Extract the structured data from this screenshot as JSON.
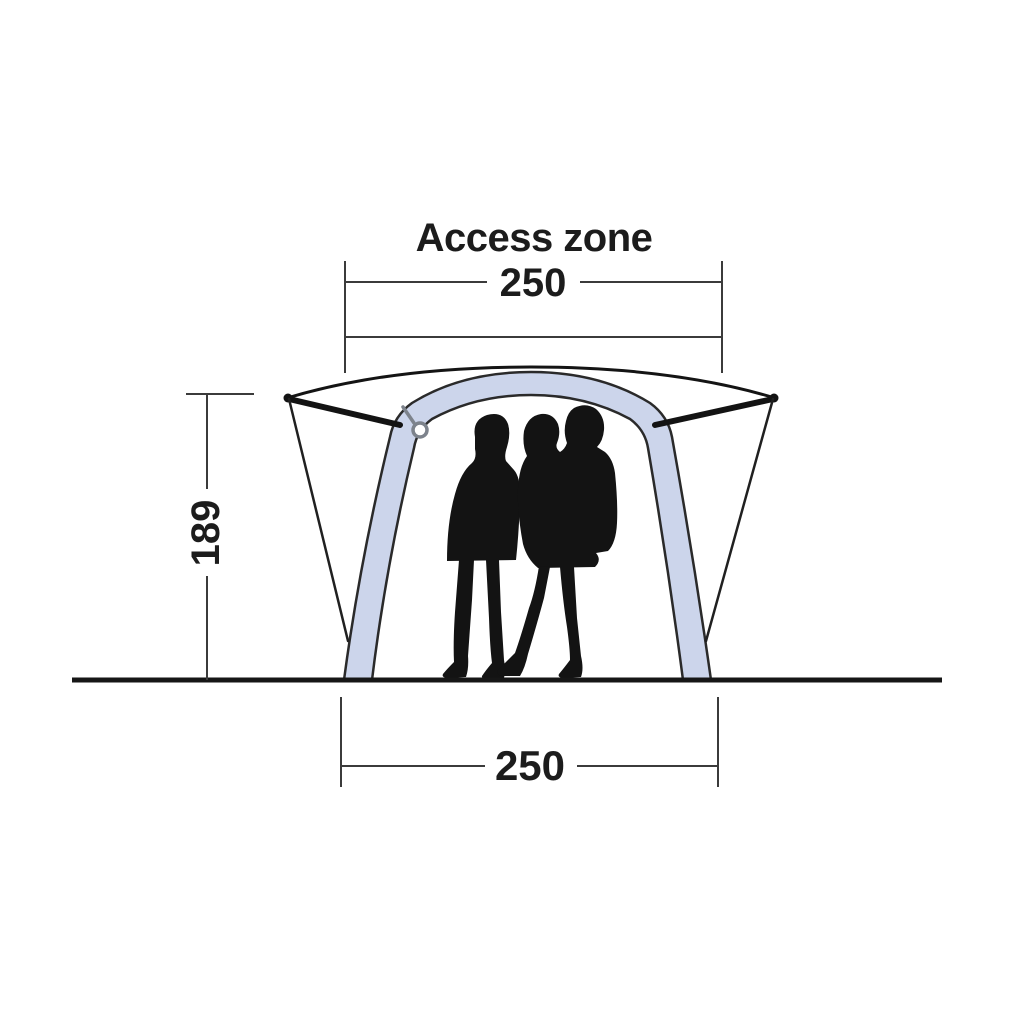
{
  "diagram": {
    "title": "Access zone",
    "dimensions": {
      "access_zone_width": "250",
      "height": "189",
      "base_width": "250"
    },
    "colors": {
      "air_tube": "#ccd5eb",
      "outline": "#141414",
      "dimension_line": "#3b3b3b",
      "silhouette": "#131313",
      "tie_ring": "#7d838c"
    }
  }
}
